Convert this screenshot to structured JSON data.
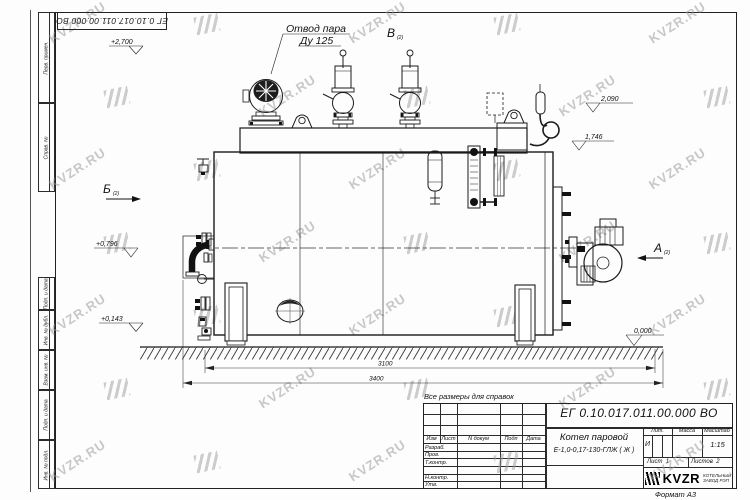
{
  "watermark": {
    "text": "KVZR.RU"
  },
  "corner_stamp": {
    "designation": "ЕГ 0.10.017.011.00.000  ВО"
  },
  "margin_column": {
    "labels": [
      "Перв. примен.",
      "Справ. №",
      "Подп. и дата",
      "Инв. № дубл.",
      "Взам. инв. №",
      "Подп. и дата",
      "Инв. № подл."
    ]
  },
  "drawing": {
    "callout_steam": {
      "line1": "Отвод пара",
      "line2": "Ду 125"
    },
    "view_b": {
      "letter": "Б",
      "ref": "(2)"
    },
    "view_v": {
      "letter": "В",
      "ref": "(2)"
    },
    "view_a": {
      "letter": "А",
      "ref": "(2)"
    },
    "elevations": {
      "top": "+2,700",
      "box": "2,090",
      "drum": "1,746",
      "elbow": "+0,796",
      "lower": "+0,143",
      "ground": "0,000"
    },
    "dimensions": {
      "inner_length": "3100",
      "overall_length": "3400"
    }
  },
  "note": {
    "text": "Все размеры для справок"
  },
  "title_block": {
    "designation": "ЕГ 0.10.017.011.00.000  ВО",
    "product_line1": "Котел паровой",
    "product_line2": "Е-1,0-0,17-130-ГЛЖ ( Ж )",
    "col_izm": "Изм",
    "col_list": "Лист",
    "col_doc": "N докум",
    "col_podp": "Подп",
    "col_data": "Дата",
    "row_razrab": "Разраб.",
    "row_prov": "Пров.",
    "row_tkontr": "Т.контр.",
    "row_nkontr": "Н.контр.",
    "row_utv": "Утв.",
    "lit_label": "Лит.",
    "lit_value": "И",
    "mass_label": "Масса",
    "scale_label": "Масштаб",
    "scale_value": "1:15",
    "sheet_label": "Лист",
    "sheet_number": "1",
    "sheets_label": "Листов",
    "sheets_number": "2",
    "company_name": "KVZR",
    "company_line1": "КОТЕЛЬНЫЙ",
    "company_line2": "ЗАВОД РЭП"
  },
  "footer": {
    "format_label": "Формат А3"
  }
}
